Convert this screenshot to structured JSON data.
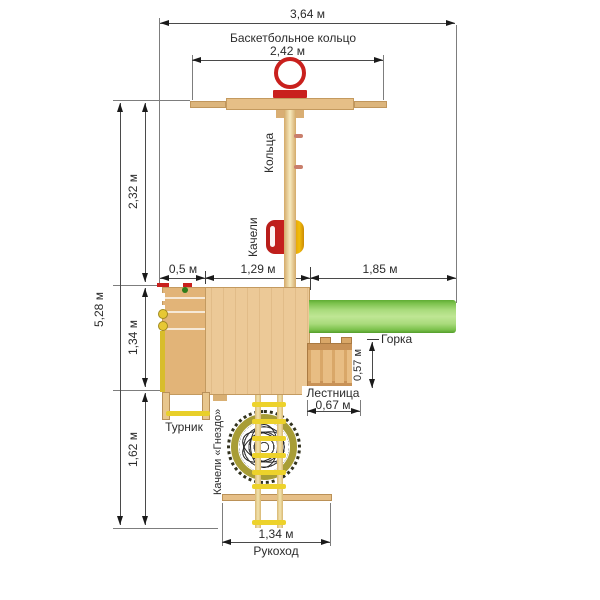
{
  "labels": {
    "basketball_hoop": "Баскетбольное кольцо",
    "rings": "Кольца",
    "swing": "Качели",
    "slide": "Горка",
    "stairs": "Лестница",
    "pullup_bar": "Турник",
    "nest_swing": "Качели «Гнездо»",
    "monkey_bars": "Рукоход"
  },
  "dims": {
    "total_width": "3,64 м",
    "hoop_beam_width": "2,42 м",
    "total_depth": "5,28 м",
    "upper_depth": "2,32 м",
    "platform_depth": "1,34 м",
    "lower_depth": "1,62 м",
    "left_offset": "0,5 м",
    "platform_width": "1,29 м",
    "slide_length": "1,85 м",
    "stairs_depth": "0,57 м",
    "stairs_width": "0,67 м",
    "monkey_bars_width": "1,34 м"
  },
  "colors": {
    "wood_light": "#ecc997",
    "wood_medium": "#d9a768",
    "accent_red": "#c9201d",
    "accent_yellow": "#eed22b",
    "slide_green": "#7cc24d",
    "nest_olive": "#a89d36"
  }
}
